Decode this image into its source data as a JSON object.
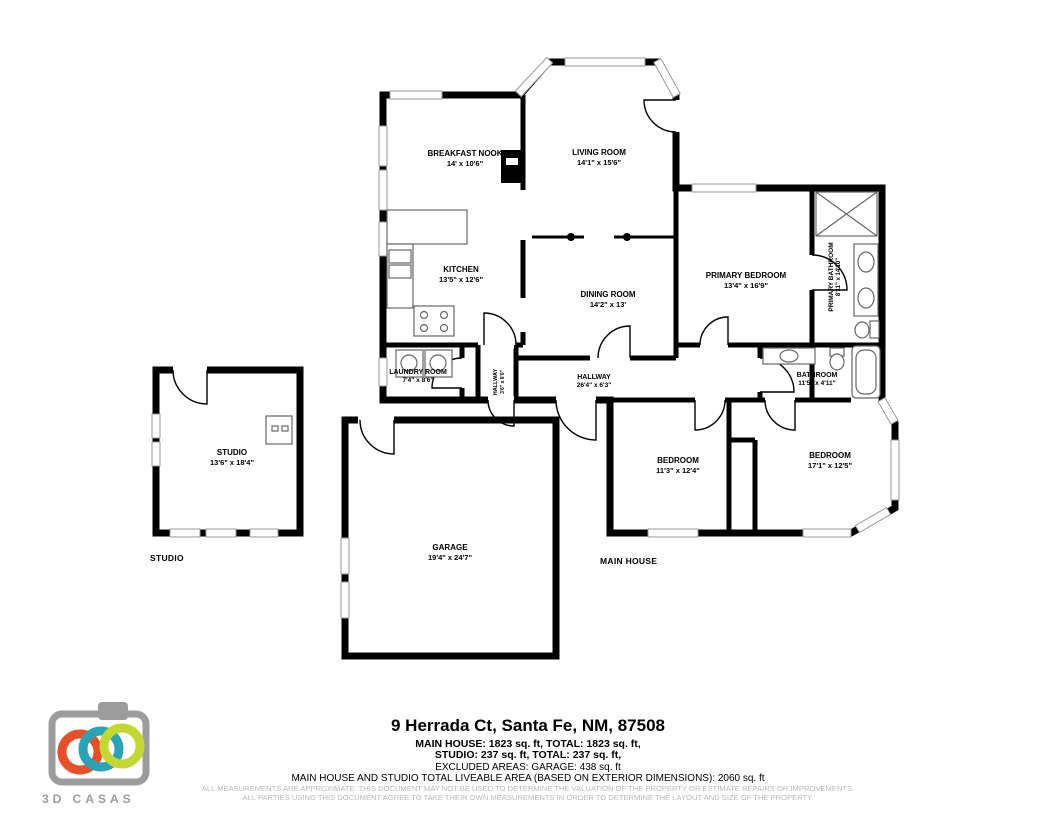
{
  "plan": {
    "rooms": [
      {
        "name": "BREAKFAST NOOK",
        "dims": "14' x 10'6\""
      },
      {
        "name": "LIVING ROOM",
        "dims": "14'1\" x 15'6\""
      },
      {
        "name": "KITCHEN",
        "dims": "13'5\" x 12'6\""
      },
      {
        "name": "DINING ROOM",
        "dims": "14'2\" x 13'"
      },
      {
        "name": "PRIMARY BEDROOM",
        "dims": "13'4\" x 16'9\""
      },
      {
        "name": "PRIMARY BATHROOM",
        "dims": "8'11\" x 14'10\""
      },
      {
        "name": "LAUNDRY ROOM",
        "dims": "7'4\" x 8'6\""
      },
      {
        "name": "HALLWAY",
        "dims": "3'6\" x 8'0\""
      },
      {
        "name": "HALLWAY",
        "dims": "26'4\" x 6'3\""
      },
      {
        "name": "BATHROOM",
        "dims": "11'5\" x 4'11\""
      },
      {
        "name": "BEDROOM",
        "dims": "11'3\" x 12'4\""
      },
      {
        "name": "BEDROOM",
        "dims": "17'1\" x 12'5\""
      },
      {
        "name": "GARAGE",
        "dims": "19'4\" x 24'7\""
      },
      {
        "name": "STUDIO",
        "dims": "13'6\" x 18'4\""
      }
    ],
    "area_labels": {
      "studio": "STUDIO",
      "main_house": "MAIN HOUSE"
    }
  },
  "footer": {
    "address": "9 Herrada Ct, Santa Fe, NM, 87508",
    "line1": "MAIN HOUSE: 1823 sq. ft, TOTAL: 1823 sq. ft,",
    "line2": "STUDIO: 237 sq. ft, TOTAL: 237 sq. ft,",
    "line3": "EXCLUDED AREAS: GARAGE: 438 sq. ft",
    "line4": "MAIN HOUSE AND STUDIO TOTAL LIVEABLE AREA (BASED ON EXTERIOR DIMENSIONS): 2060 sq. ft",
    "disclaimer1": "ALL MEASUREMENTS ARE APPROXIMATE. THIS DOCUMENT MAY NOT BE USED TO DETERMINE THE VALUATION OF THE PROPERTY OR ESTIMATE REPAIRS OR IMPROVEMENTS.",
    "disclaimer2": "ALL PARTIES USING THIS DOCUMENT AGREE TO TAKE THEIR OWN MEASUREMENTS IN ORDER TO DETERMINE THE LAYOUT AND SIZE OF THE PROPERTY."
  },
  "logo": {
    "text": "3D CASAS",
    "colors": {
      "ring_orange": "#e8502a",
      "ring_teal": "#29a3b8",
      "ring_lime": "#c3d931",
      "camera": "#9c9c9c"
    }
  }
}
